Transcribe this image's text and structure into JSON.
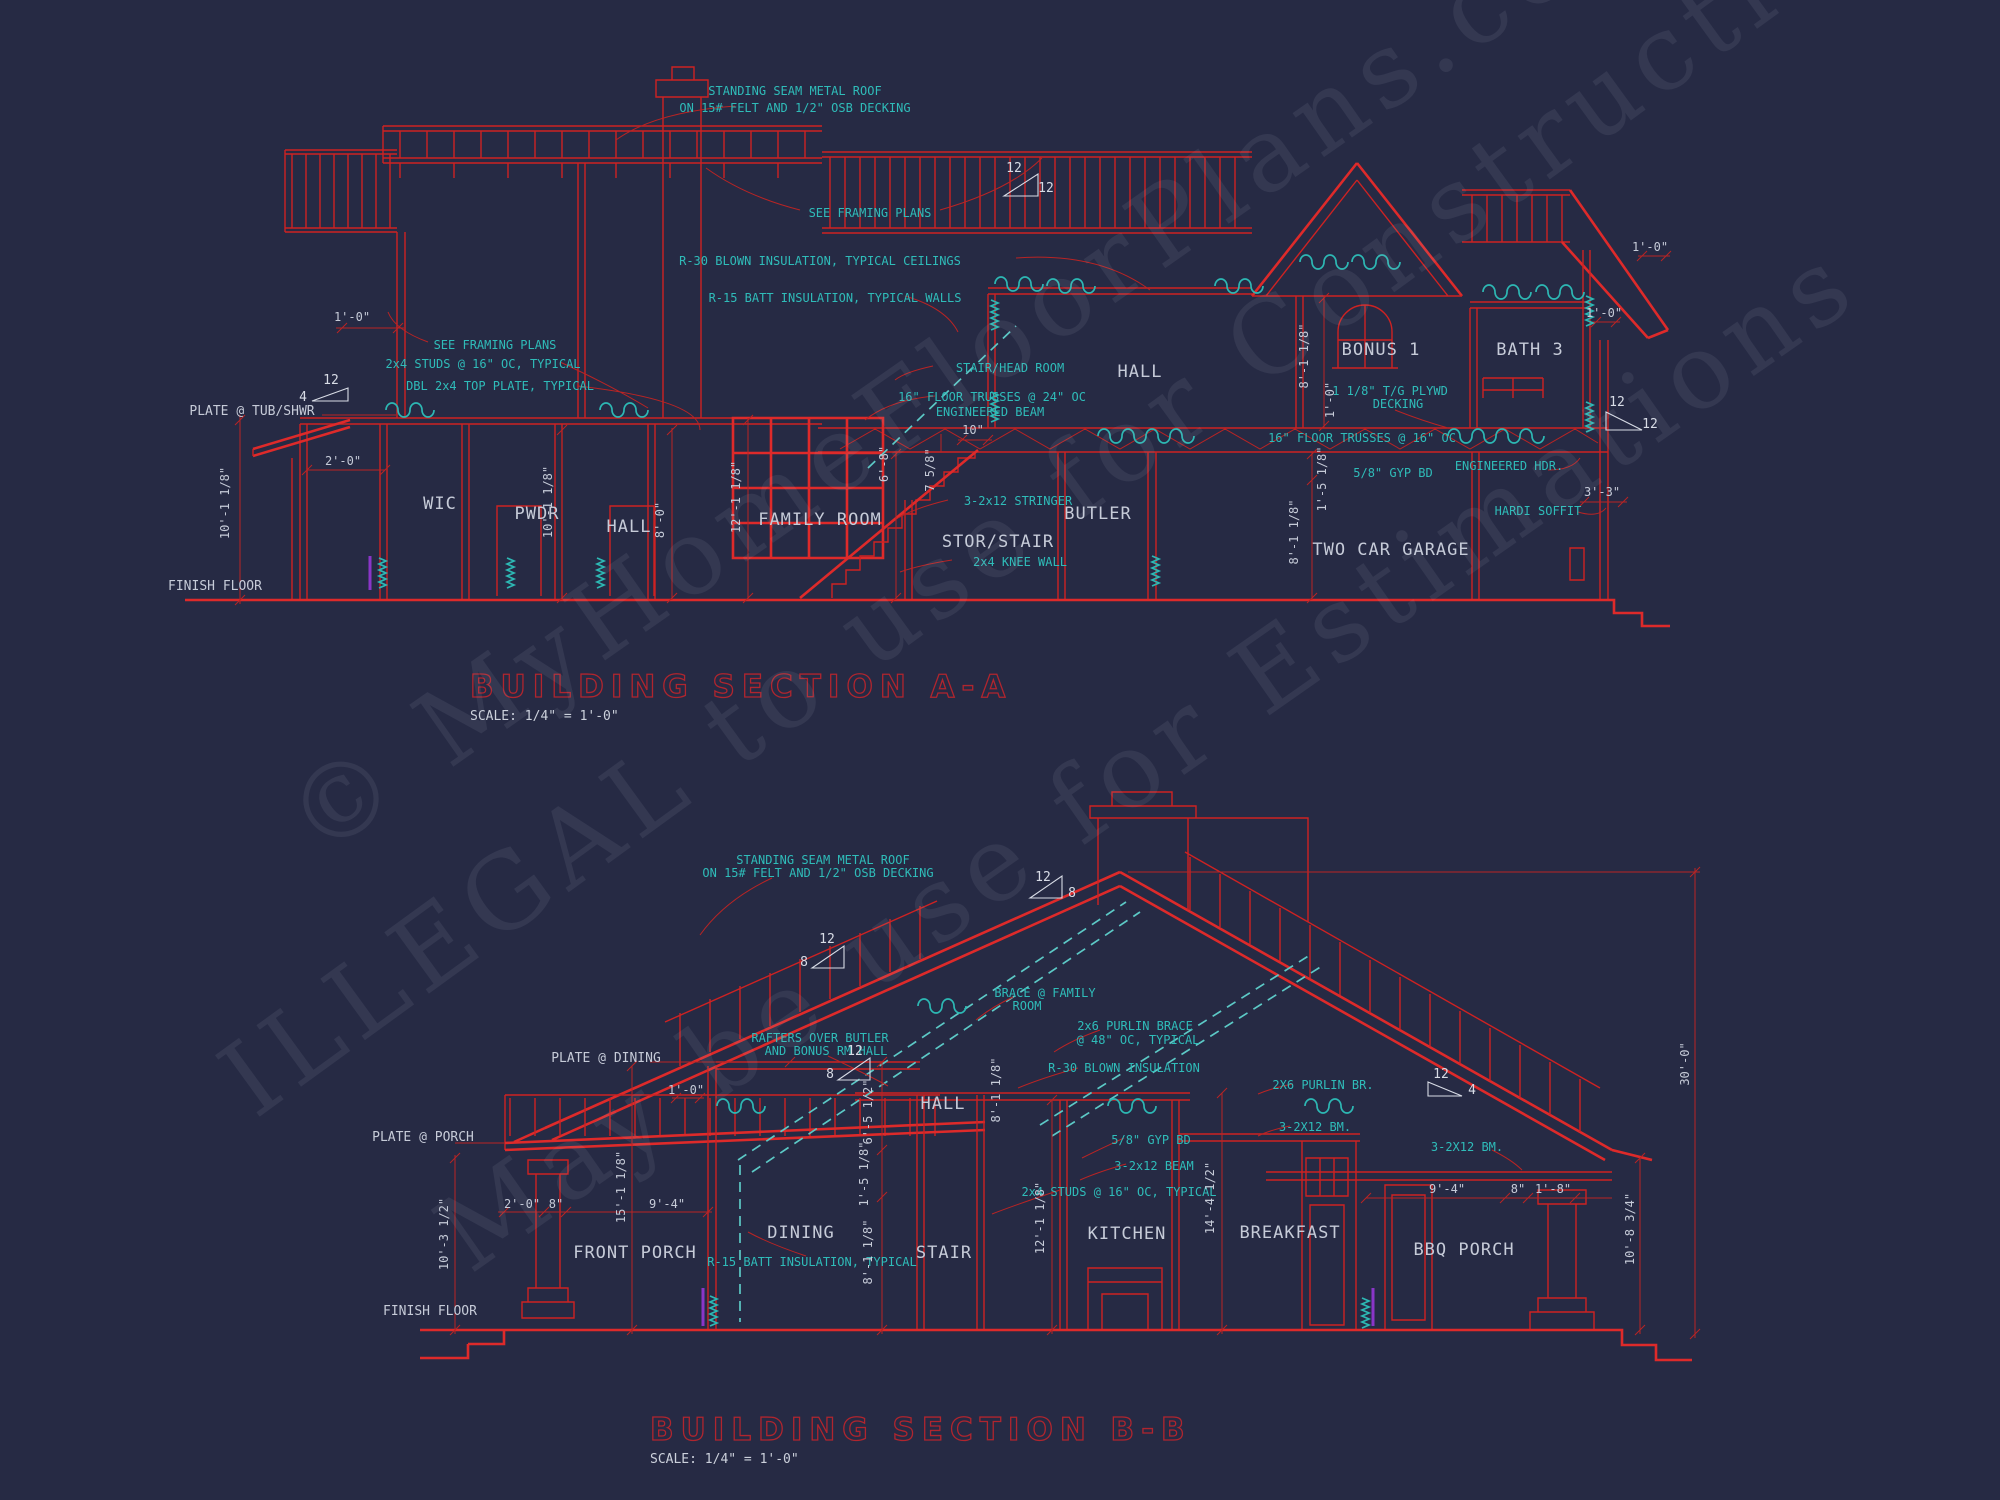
{
  "colors": {
    "background": "#262a44",
    "line_red": "#ce2222",
    "annotation_cyan": "#2fbcb9",
    "label_white": "#c6cbd8",
    "title_red": "#b0252e",
    "accent_violet": "#8a35c8"
  },
  "watermark": [
    "© MyHomeFloorPlans.com",
    "May be use for Estimations",
    "ILLEGAL to use for Construction"
  ],
  "sectionA": {
    "title": "BUILDING SECTION A-A",
    "scale": "SCALE: 1/4\" = 1'-0\"",
    "notes": [
      "STANDING SEAM METAL ROOF",
      "ON 15# FELT AND 1/2\" OSB DECKING",
      "SEE FRAMING PLANS",
      "R-30 BLOWN INSULATION, TYPICAL CEILINGS",
      "R-15 BATT INSULATION, TYPICAL WALLS",
      "SEE FRAMING PLANS",
      "2x4 STUDS @ 16\" OC, TYPICAL",
      "DBL 2x4 TOP PLATE, TYPICAL",
      "STAIR/HEAD ROOM",
      "16\" FLOOR TRUSSES @ 24\" OC",
      "ENGINEERED BEAM",
      "3-2x12 STRINGER",
      "2x4 KNEE WALL",
      "16\" FLOOR TRUSSES @ 16\" OC",
      "5/8\" GYP BD",
      "ENGINEERED HDR.",
      "HARDI SOFFIT",
      "1 1/8\" T/G PLYWD",
      "DECKING"
    ],
    "rooms": [
      "WIC",
      "PWDR",
      "HALL",
      "FAMILY ROOM",
      "STOR/STAIR",
      "BUTLER",
      "HALL",
      "BONUS 1",
      "BATH 3",
      "TWO CAR GARAGE"
    ],
    "refs": [
      "PLATE @ TUB/SHWR",
      "FINISH FLOOR"
    ],
    "dims": [
      "1'-0\"",
      "2'-0\"",
      "10'-1 1/8\"",
      "10'-1 1/8\"",
      "8'-0\"",
      "12'-1 1/8\"",
      "6'-8\"",
      "7 5/8\"",
      "10\"",
      "8'-1 1/8\"",
      "1'-0\"",
      "1'-0\"",
      "8'-1 1/8\"",
      "1'-5 1/8\"",
      "3'-3\"",
      "1'-0\""
    ],
    "slopes": [
      "12",
      "4",
      "12",
      "12",
      "12",
      "12"
    ]
  },
  "sectionB": {
    "title": "BUILDING SECTION B-B",
    "scale": "SCALE: 1/4\" = 1'-0\"",
    "notes": [
      "STANDING SEAM METAL ROOF",
      "ON 15# FELT AND 1/2\" OSB DECKING",
      "BRACE @ FAMILY",
      "ROOM",
      "2x6 PURLIN BRACE",
      "@ 48\" OC, TYPICAL",
      "RAFTERS OVER BUTLER",
      "AND BONUS RM HALL",
      "R-30 BLOWN INSULATION",
      "2X6 PURLIN BR.",
      "3-2X12 BM.",
      "3-2X12 BM.",
      "5/8\" GYP BD",
      "3-2x12 BEAM",
      "2x4 STUDS @ 16\" OC, TYPICAL",
      "R-15 BATT INSULATION, TYPICAL"
    ],
    "rooms": [
      "FRONT PORCH",
      "DINING",
      "STAIR",
      "HALL",
      "KITCHEN",
      "BREAKFAST",
      "BBQ PORCH"
    ],
    "refs": [
      "PLATE @ DINING",
      "PLATE @ PORCH",
      "FINISH FLOOR"
    ],
    "dims": [
      "1'-0\"",
      "2'-0\"",
      "8\"",
      "9'-4\"",
      "15'-1 1/8\"",
      "10'-3 1/2\"",
      "6'-5 1/2\"",
      "1'-5 1/8\"",
      "8'-1 1/8\"",
      "8'-1 1/8\"",
      "12'-1 1/8\"",
      "14'-4 1/2\"",
      "9'-4\"",
      "8\"",
      "1'-8\"",
      "10'-8 3/4\"",
      "30'-0\""
    ],
    "slopes": [
      "12",
      "8",
      "12",
      "8",
      "12",
      "8",
      "12",
      "4"
    ]
  }
}
